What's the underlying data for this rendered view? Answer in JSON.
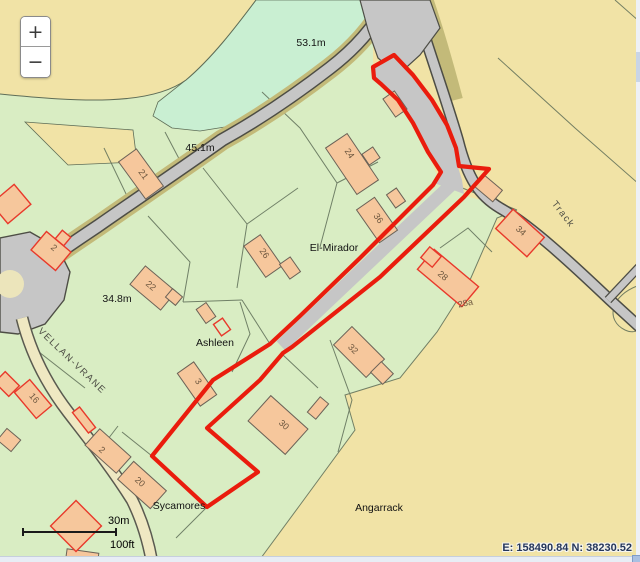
{
  "controls": {
    "zoom_in_label": "+",
    "zoom_out_label": "−"
  },
  "scalebar": {
    "metric_label": "30m",
    "imperial_label": "100ft"
  },
  "statusbar": {
    "coordinates": "E: 158490.84 N: 38230.52"
  },
  "map": {
    "colors": {
      "selection_red": "#ea1c0d",
      "parcel_green": "#d9edc3",
      "parcel_mint": "#c9efd2",
      "land_tan": "#f1e3a6",
      "road_gray": "#c6c6c6",
      "road_pale": "#efe8c2",
      "verge_olive": "#c3ba79",
      "building_orange": "#f6c79c",
      "building_red_outline": "#e8392b"
    },
    "labels": [
      {
        "text": "53.1m",
        "x": 311,
        "y": 46,
        "rot": 0,
        "cls": "measure"
      },
      {
        "text": "45.1m",
        "x": 200,
        "y": 151,
        "rot": 0,
        "cls": "measure"
      },
      {
        "text": "34.8m",
        "x": 117,
        "y": 302,
        "rot": 0,
        "cls": "measure"
      },
      {
        "text": "El-Mirador",
        "x": 334,
        "y": 251,
        "rot": 0,
        "cls": "place"
      },
      {
        "text": "Ashleen",
        "x": 215,
        "y": 346,
        "rot": 0,
        "cls": "place"
      },
      {
        "text": "Sycamores",
        "x": 179,
        "y": 509,
        "rot": 0,
        "cls": "place"
      },
      {
        "text": "Angarrack",
        "x": 379,
        "y": 511,
        "rot": 0,
        "cls": "place"
      },
      {
        "text": "Track",
        "x": 561,
        "y": 216,
        "rot": 52,
        "cls": "roadname"
      },
      {
        "text": "VELLAN-VRANE",
        "x": 70,
        "y": 363,
        "rot": 44,
        "cls": "roadname"
      },
      {
        "text": "21",
        "x": 141,
        "y": 176,
        "rot": 54,
        "cls": "number"
      },
      {
        "text": "24",
        "x": 347,
        "y": 155,
        "rot": 56,
        "cls": "number"
      },
      {
        "text": "36",
        "x": 376,
        "y": 220,
        "rot": 55,
        "cls": "number"
      },
      {
        "text": "26",
        "x": 262,
        "y": 255,
        "rot": 55,
        "cls": "number"
      },
      {
        "text": "22",
        "x": 149,
        "y": 288,
        "rot": 40,
        "cls": "number"
      },
      {
        "text": "34",
        "x": 519,
        "y": 233,
        "rot": 42,
        "cls": "number"
      },
      {
        "text": "28",
        "x": 441,
        "y": 278,
        "rot": 40,
        "cls": "number"
      },
      {
        "text": "28a",
        "x": 466,
        "y": 306,
        "rot": -12,
        "cls": "number"
      },
      {
        "text": "32",
        "x": 351,
        "y": 351,
        "rot": 45,
        "cls": "number"
      },
      {
        "text": "30",
        "x": 282,
        "y": 427,
        "rot": 42,
        "cls": "number"
      },
      {
        "text": "3",
        "x": 196,
        "y": 383,
        "rot": 55,
        "cls": "number"
      },
      {
        "text": "16",
        "x": 32,
        "y": 400,
        "rot": 50,
        "cls": "number"
      },
      {
        "text": "2",
        "x": 52,
        "y": 250,
        "rot": 40,
        "cls": "number"
      },
      {
        "text": "2",
        "x": 100,
        "y": 452,
        "rot": 42,
        "cls": "number"
      },
      {
        "text": "20",
        "x": 138,
        "y": 484,
        "rot": 42,
        "cls": "number"
      }
    ]
  }
}
